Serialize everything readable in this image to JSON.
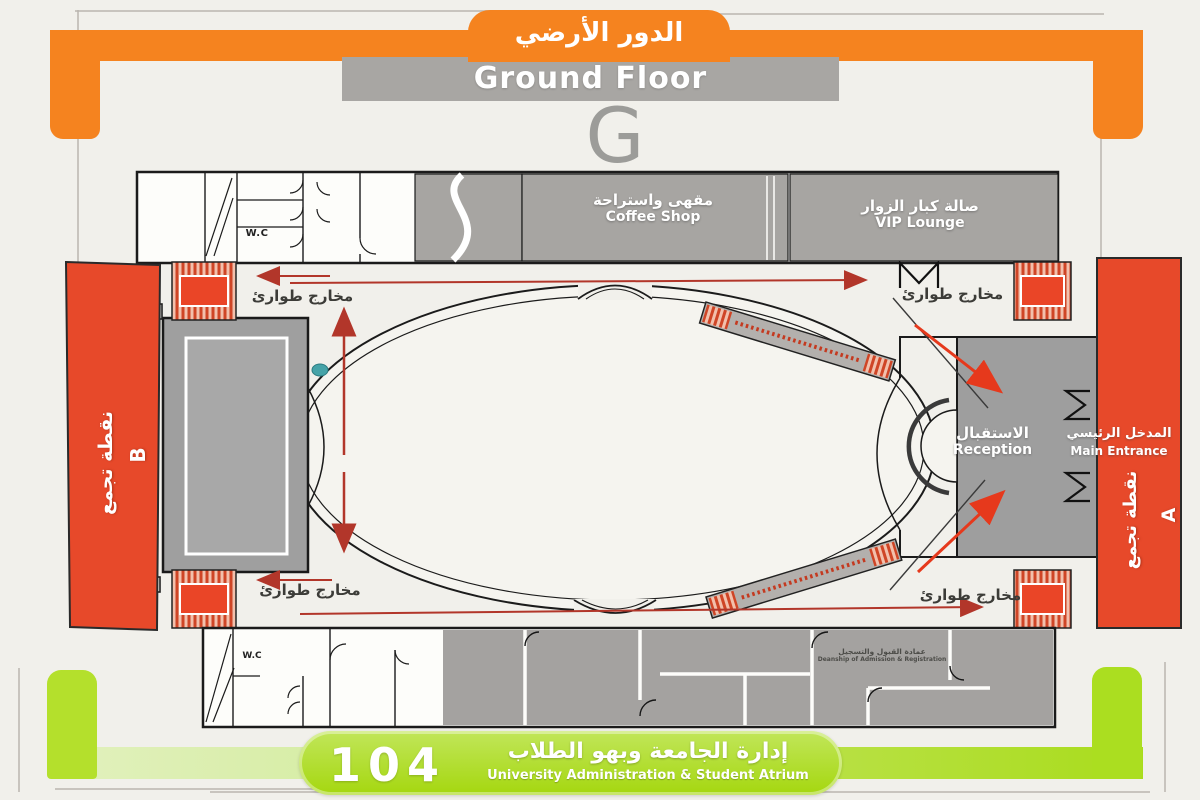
{
  "header": {
    "title_ar": "الدور الأرضي",
    "title_en": "Ground Floor",
    "floor_letter": "G"
  },
  "rooms": {
    "coffee_shop": {
      "ar": "مقهى واستراحة",
      "en": "Coffee Shop"
    },
    "vip_lounge": {
      "ar": "صالة كبار الزوار",
      "en": "VIP Lounge"
    },
    "reception": {
      "ar": "الاستقبال",
      "en": "Reception"
    },
    "main_entrance": {
      "ar": "المدخل الرئيسي",
      "en": "Main Entrance"
    },
    "admissions": {
      "ar": "عمادة القبول والتسجيل",
      "en": "Deanship of Admission & Registration"
    },
    "wc": "W.C"
  },
  "labels": {
    "emergency_exits_ar": "مخارج طوارئ",
    "assembly_point_ar": "نقطة تجمع",
    "assembly_b": "B",
    "assembly_a": "A"
  },
  "footer": {
    "number": "104",
    "label_ar": "إدارة الجامعة وبهو الطلاب",
    "label_en": "University Administration & Student Atrium"
  },
  "colors": {
    "orange": "#F5831F",
    "assembly_red": "#E7492A",
    "arrow_red": "#B2362A",
    "green": "#A9DC1C",
    "room_gray": "#A7A5A2"
  }
}
